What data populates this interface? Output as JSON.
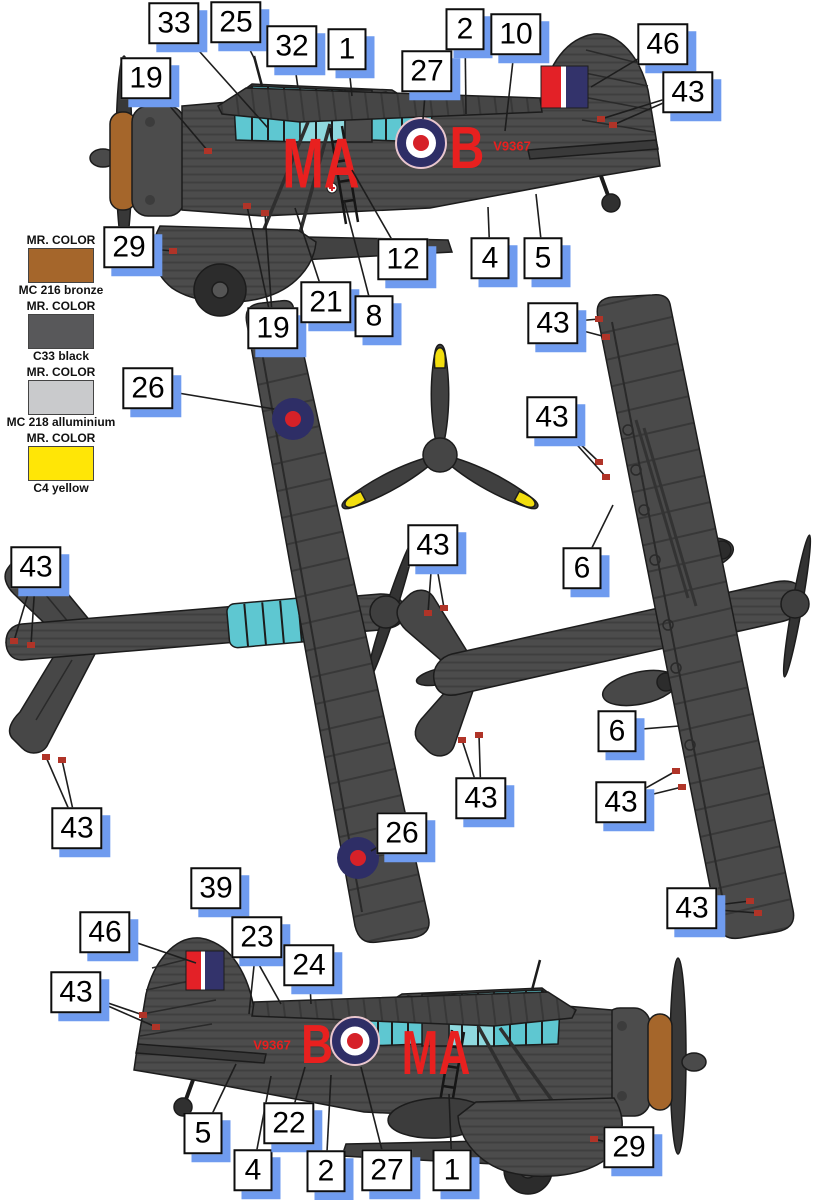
{
  "colors": {
    "airframe": "#4c4c4c",
    "outline": "#1c1c1c",
    "canopy": "#5ec7d1",
    "canopy_light": "#8fd9df",
    "bronze": "#a5662b",
    "marking_red": "#e8201f",
    "roundel_blue": "#2e2e66",
    "roundel_red": "#d62128",
    "fin_flash_red": "#e32127",
    "fin_flash_blue": "#33336b",
    "stencil_red": "#b03428",
    "prop_yellow": "#f2de0f",
    "callout_shadow": "#6f9bef"
  },
  "legend": {
    "items": [
      {
        "brand": "MR. COLOR",
        "name": "MC 216 bronze",
        "swatch": "#a5662b"
      },
      {
        "brand": "MR. COLOR",
        "name": "C33 black",
        "swatch": "#58585a"
      },
      {
        "brand": "MR. COLOR",
        "name": "MC 218 alluminium",
        "swatch": "#c9cacc"
      },
      {
        "brand": "MR. COLOR",
        "name": "C4 yellow",
        "swatch": "#ffe606"
      }
    ]
  },
  "markings": {
    "code": "MA",
    "letter": "B",
    "serial": "V9367"
  },
  "callouts": [
    {
      "label": "33",
      "x": 174,
      "y": 23,
      "targets": [
        [
          268,
          128
        ]
      ]
    },
    {
      "label": "25",
      "x": 236,
      "y": 22,
      "targets": [
        [
          256,
          62
        ]
      ]
    },
    {
      "label": "32",
      "x": 292,
      "y": 46,
      "targets": [
        [
          298,
          88
        ]
      ]
    },
    {
      "label": "1",
      "x": 347,
      "y": 49,
      "targets": [
        [
          352,
          96
        ]
      ]
    },
    {
      "label": "27",
      "x": 427,
      "y": 71,
      "targets": [
        [
          423,
          119
        ]
      ]
    },
    {
      "label": "2",
      "x": 465,
      "y": 29,
      "targets": [
        [
          466,
          114
        ]
      ]
    },
    {
      "label": "10",
      "x": 516,
      "y": 34,
      "targets": [
        [
          505,
          131
        ]
      ]
    },
    {
      "label": "46",
      "x": 663,
      "y": 44,
      "targets": [
        [
          591,
          87
        ]
      ]
    },
    {
      "label": "43",
      "x": 688,
      "y": 92,
      "stencil": true,
      "targets": [
        [
          601,
          119
        ],
        [
          613,
          125
        ]
      ]
    },
    {
      "label": "19",
      "x": 146,
      "y": 78,
      "stencil": true,
      "targets": [
        [
          208,
          151
        ]
      ]
    },
    {
      "label": "29",
      "x": 129,
      "y": 247,
      "stencil": true,
      "targets": [
        [
          173,
          251
        ]
      ]
    },
    {
      "label": "19",
      "x": 273,
      "y": 328,
      "stencil": true,
      "targets": [
        [
          247,
          206
        ],
        [
          265,
          213
        ]
      ]
    },
    {
      "label": "21",
      "x": 326,
      "y": 302,
      "targets": [
        [
          295,
          208
        ]
      ]
    },
    {
      "label": "8",
      "x": 374,
      "y": 316,
      "targets": [
        [
          344,
          200
        ]
      ]
    },
    {
      "label": "12",
      "x": 403,
      "y": 259,
      "targets": [
        [
          352,
          170
        ]
      ]
    },
    {
      "label": "4",
      "x": 490,
      "y": 258,
      "targets": [
        [
          488,
          207
        ]
      ]
    },
    {
      "label": "5",
      "x": 543,
      "y": 258,
      "targets": [
        [
          536,
          194
        ]
      ]
    },
    {
      "label": "26",
      "x": 148,
      "y": 388,
      "targets": [
        [
          274,
          409
        ]
      ]
    },
    {
      "label": "43",
      "x": 36,
      "y": 567,
      "stencil": true,
      "targets": [
        [
          14,
          641
        ],
        [
          31,
          645
        ]
      ]
    },
    {
      "label": "43",
      "x": 77,
      "y": 828,
      "stencil": true,
      "targets": [
        [
          46,
          757
        ],
        [
          62,
          760
        ]
      ]
    },
    {
      "label": "26",
      "x": 402,
      "y": 833,
      "targets": [
        [
          371,
          851
        ]
      ]
    },
    {
      "label": "43",
      "x": 433,
      "y": 545,
      "stencil": true,
      "targets": [
        [
          428,
          613
        ],
        [
          444,
          608
        ]
      ]
    },
    {
      "label": "43",
      "x": 481,
      "y": 798,
      "stencil": true,
      "targets": [
        [
          462,
          740
        ],
        [
          479,
          735
        ]
      ]
    },
    {
      "label": "43",
      "x": 553,
      "y": 323,
      "stencil": true,
      "targets": [
        [
          599,
          319
        ],
        [
          606,
          337
        ]
      ]
    },
    {
      "label": "43",
      "x": 552,
      "y": 417,
      "stencil": true,
      "targets": [
        [
          599,
          462
        ],
        [
          606,
          477
        ]
      ]
    },
    {
      "label": "6",
      "x": 582,
      "y": 568,
      "targets": [
        [
          613,
          505
        ]
      ]
    },
    {
      "label": "6",
      "x": 617,
      "y": 731,
      "targets": [
        [
          679,
          726
        ]
      ]
    },
    {
      "label": "43",
      "x": 621,
      "y": 802,
      "stencil": true,
      "targets": [
        [
          676,
          771
        ],
        [
          682,
          787
        ]
      ]
    },
    {
      "label": "43",
      "x": 692,
      "y": 908,
      "stencil": true,
      "targets": [
        [
          750,
          901
        ],
        [
          758,
          913
        ]
      ]
    },
    {
      "label": "39",
      "x": 216,
      "y": 888,
      "targets": [
        [
          281,
          1004
        ]
      ]
    },
    {
      "label": "46",
      "x": 105,
      "y": 932,
      "targets": [
        [
          196,
          963
        ]
      ]
    },
    {
      "label": "23",
      "x": 257,
      "y": 937,
      "targets": [
        [
          249,
          1014
        ]
      ]
    },
    {
      "label": "24",
      "x": 309,
      "y": 965,
      "targets": [
        [
          311,
          1004
        ]
      ]
    },
    {
      "label": "43",
      "x": 76,
      "y": 992,
      "stencil": true,
      "targets": [
        [
          143,
          1015
        ],
        [
          156,
          1027
        ]
      ]
    },
    {
      "label": "5",
      "x": 203,
      "y": 1133,
      "targets": [
        [
          236,
          1064
        ]
      ]
    },
    {
      "label": "4",
      "x": 253,
      "y": 1170,
      "targets": [
        [
          271,
          1076
        ]
      ]
    },
    {
      "label": "22",
      "x": 289,
      "y": 1123,
      "targets": [
        [
          305,
          1067
        ]
      ]
    },
    {
      "label": "2",
      "x": 326,
      "y": 1171,
      "targets": [
        [
          331,
          1075
        ]
      ]
    },
    {
      "label": "27",
      "x": 387,
      "y": 1170,
      "targets": [
        [
          361,
          1067
        ]
      ]
    },
    {
      "label": "1",
      "x": 452,
      "y": 1170,
      "targets": [
        [
          449,
          1094
        ]
      ]
    },
    {
      "label": "29",
      "x": 629,
      "y": 1147,
      "stencil": true,
      "targets": [
        [
          594,
          1139
        ]
      ]
    }
  ]
}
